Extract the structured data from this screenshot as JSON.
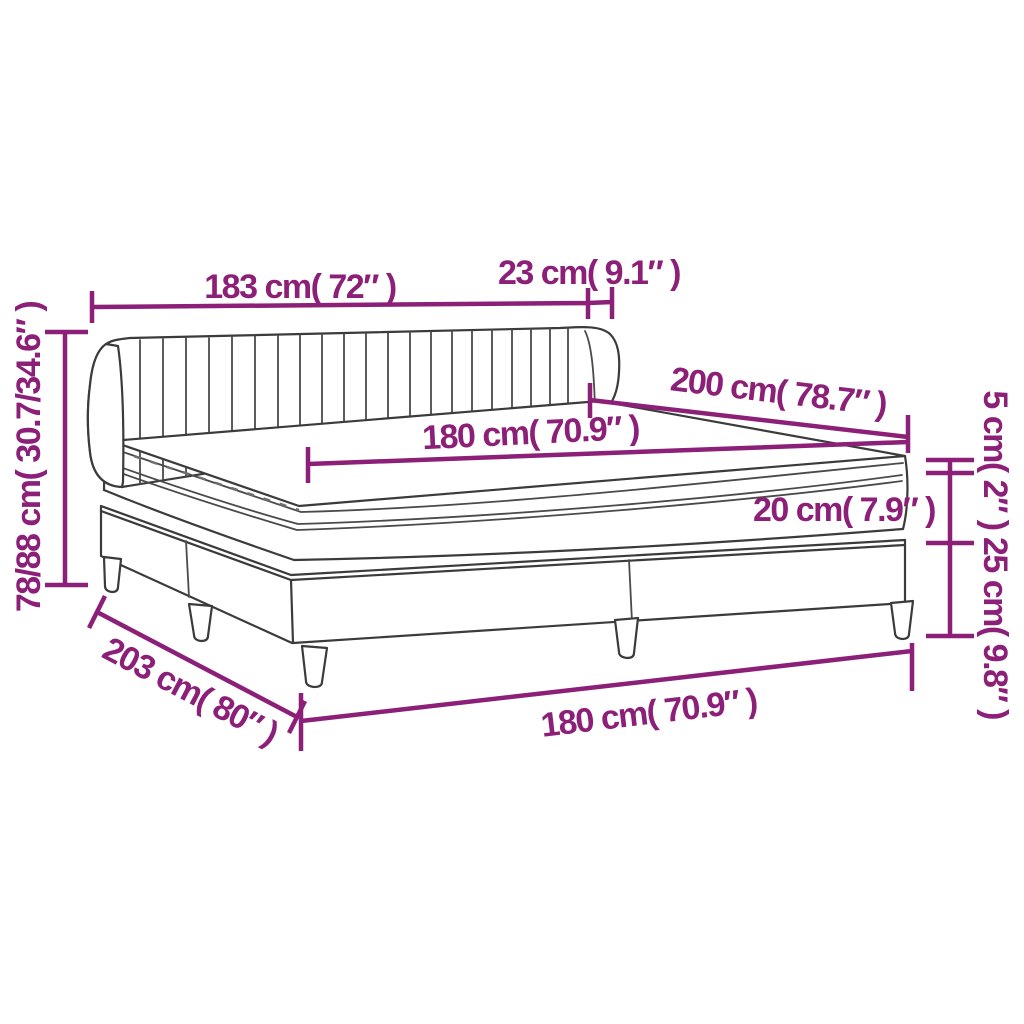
{
  "diagram": {
    "description": "Box spring bed with channel-tufted headboard, mattress and topper — dimension drawing",
    "accent_color": "#8C1F78",
    "line_color": "#3b3b3b",
    "background": "#ffffff",
    "labels": {
      "headboard_width": "183 cm( 72″ )",
      "headboard_depth": "23 cm( 9.1″ )",
      "length": "200 cm( 78.7″ )",
      "mattress_width": "180 cm( 70.9″ )",
      "topper_height": "5 cm( 2″ )",
      "mattress_height": "20 cm( 7.9″ )",
      "base_height": "25 cm( 9.8″ )",
      "total_height": "78/88 cm( 30.7/34.6″ )",
      "total_length": "203 cm( 80″ )",
      "base_width": "180 cm( 70.9″ )"
    }
  }
}
